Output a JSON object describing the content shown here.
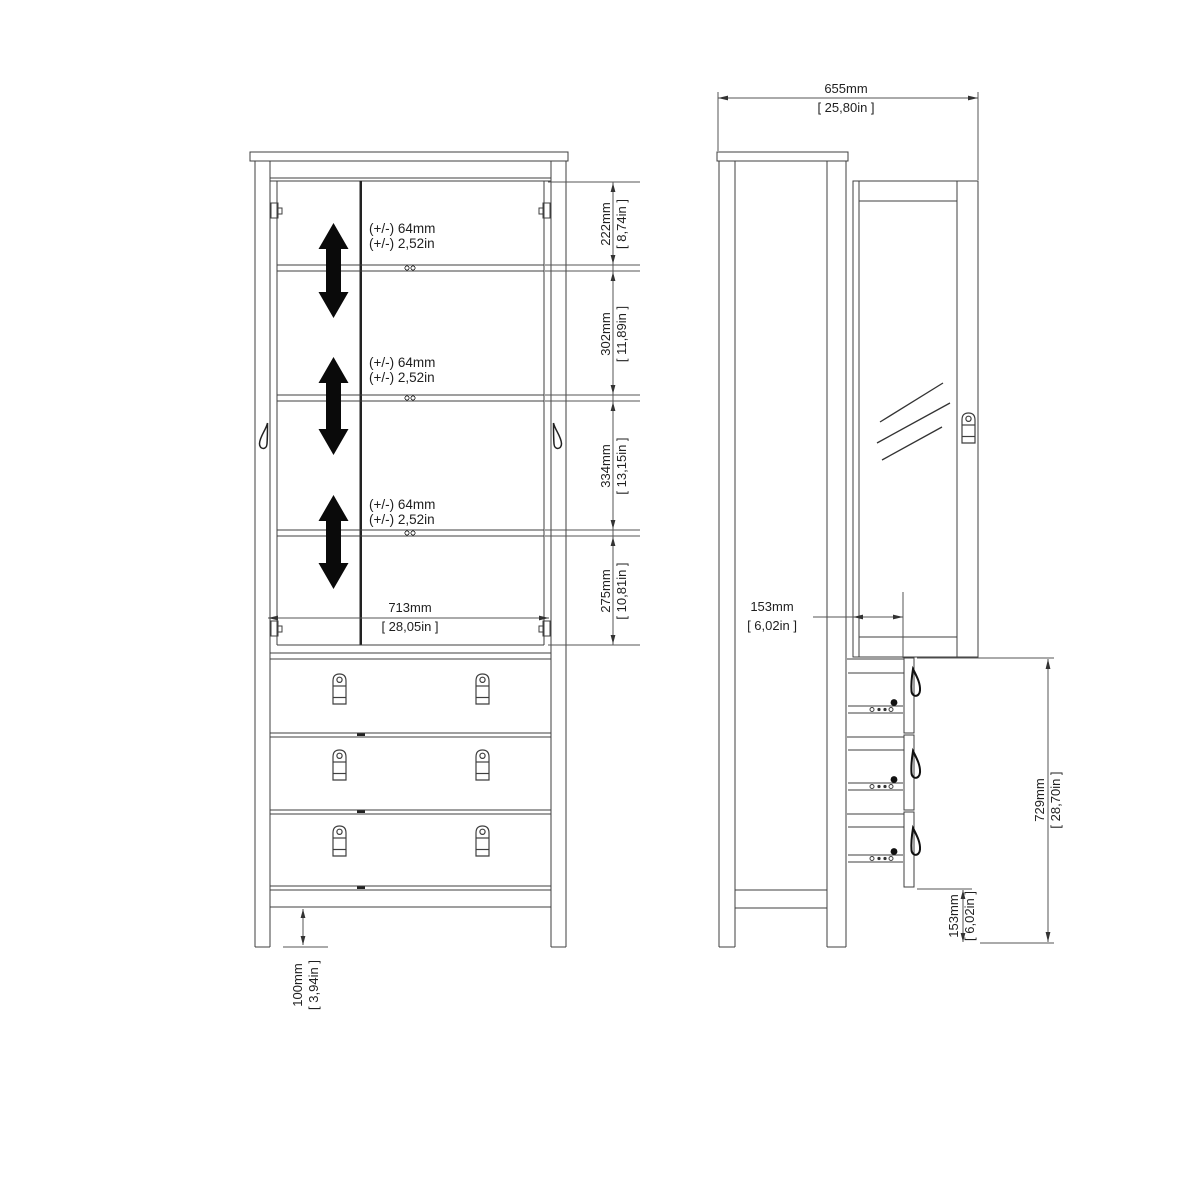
{
  "front": {
    "shelf_adjust_labels": [
      {
        "mm": "(+/-) 64mm",
        "in": "(+/-) 2,52in"
      },
      {
        "mm": "(+/-) 64mm",
        "in": "(+/-) 2,52in"
      },
      {
        "mm": "(+/-) 64mm",
        "in": "(+/-) 2,52in"
      }
    ],
    "dim_sections": [
      {
        "mm": "222mm",
        "in": "[ 8,74in ]"
      },
      {
        "mm": "302mm",
        "in": "[ 11,89in ]"
      },
      {
        "mm": "334mm",
        "in": "[ 13,15in ]"
      },
      {
        "mm": "275mm",
        "in": "[ 10,81in ]"
      }
    ],
    "dim_interior_width": {
      "mm": "713mm",
      "in": "[ 28,05in ]"
    },
    "dim_leg_height": {
      "mm": "100mm",
      "in": "[ 3,94in ]"
    }
  },
  "side": {
    "dim_depth": {
      "mm": "655mm",
      "in": "[ 25,80in ]"
    },
    "dim_drawer_offset": {
      "mm": "153mm",
      "in": "[ 6,02in ]"
    },
    "dim_drawer_section_height": {
      "mm": "729mm",
      "in": "[ 28,70in ]"
    },
    "dim_plinth_height": {
      "mm": "153mm",
      "in": "[ 6,02in ]"
    }
  },
  "colors": {
    "line": "#3f3f3f",
    "text": "#1f1f1f",
    "solid_black": "#0a0a0a",
    "background": "#ffffff"
  }
}
